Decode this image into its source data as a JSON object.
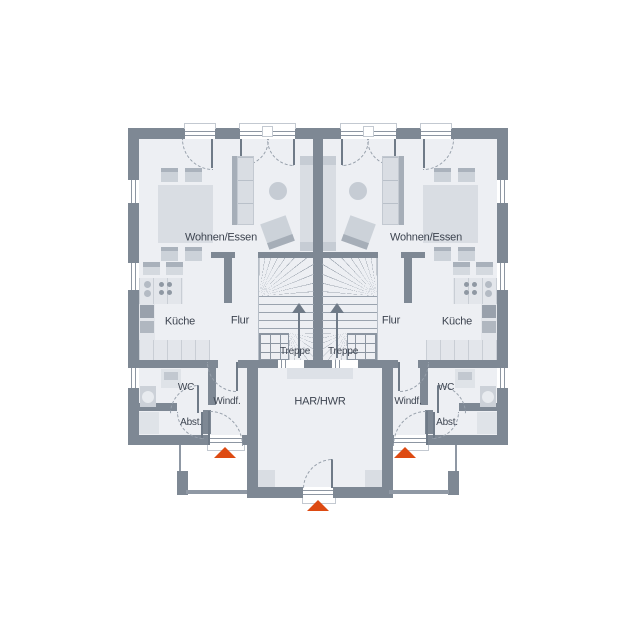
{
  "labels": {
    "left": {
      "living": "Wohnen/Essen",
      "kitchen": "Küche",
      "hall": "Flur",
      "stairs": "Treppe",
      "wc": "WC",
      "vestibule": "Windf.",
      "storage": "Abst."
    },
    "right": {
      "living": "Wohnen/Essen",
      "kitchen": "Küche",
      "hall": "Flur",
      "stairs": "Treppe",
      "wc": "WC",
      "vestibule": "Windf.",
      "storage": "Abst."
    },
    "center": {
      "utility": "HAR/HWR"
    }
  },
  "colors": {
    "wall": "#7e8894",
    "floor": "#edeff3",
    "accent": "#dd4a12",
    "text": "#3d4450",
    "furnLight": "#d9dde3",
    "furnMid": "#c6ccd4",
    "furnDark": "#a6aeb8"
  }
}
